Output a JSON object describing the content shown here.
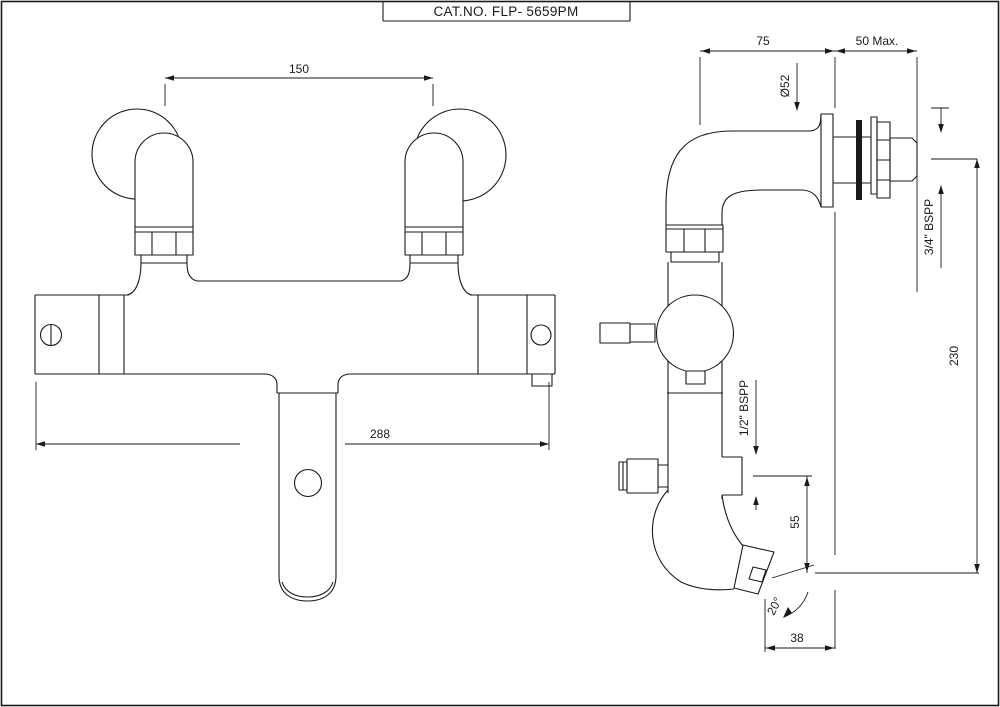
{
  "title": "CAT.NO. FLP- 5659PM",
  "colors": {
    "line": "#1a1a1a",
    "background": "#ffffff"
  },
  "front_view": {
    "dim_inlet_centers": "150",
    "dim_overall_width": "288"
  },
  "side_view": {
    "dim_body_to_wall": "75",
    "dim_wall_max": "50 Max.",
    "dim_flange_diameter": "Ø52",
    "dim_inlet_thread": "3/4\" BSPP",
    "dim_overall_height": "230",
    "dim_shower_thread": "1/2\" BSPP",
    "dim_outlet_drop": "55",
    "dim_spout_angle": "20°",
    "dim_outlet_offset": "38"
  }
}
